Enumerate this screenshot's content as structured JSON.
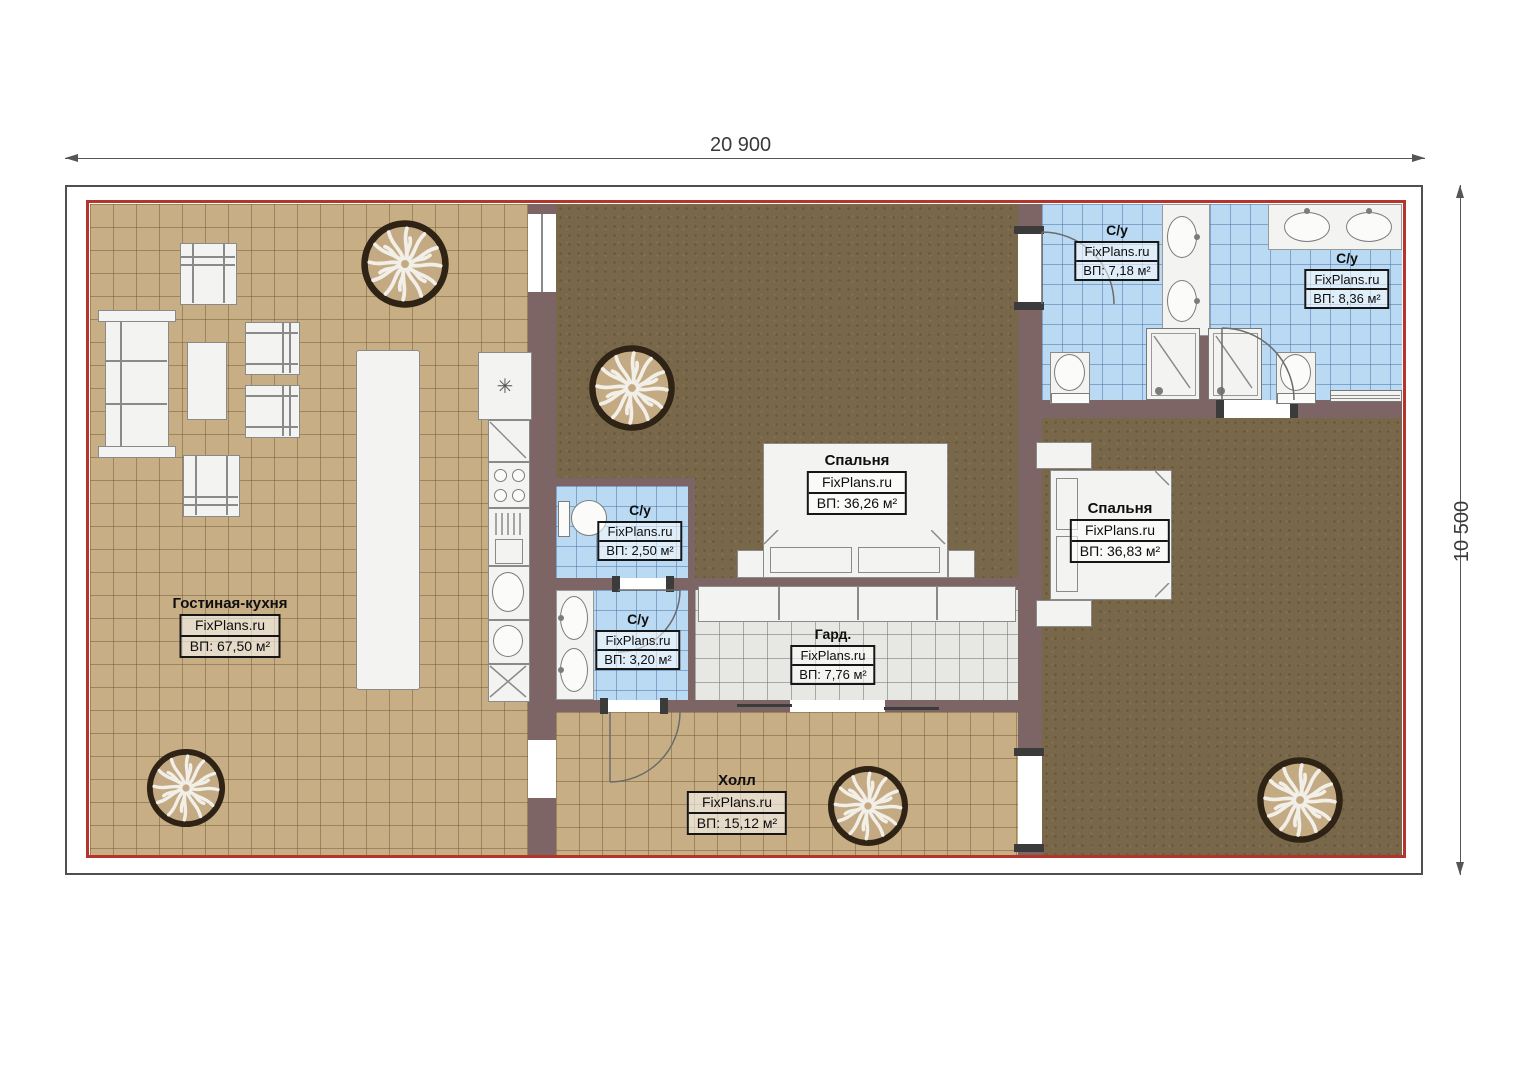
{
  "dimensions": {
    "top": "20 900",
    "right": "10 500"
  },
  "rooms": {
    "living_kitchen": {
      "name": "Гостиная-кухня",
      "watermark": "FixPlans.ru",
      "area": "ВП: 67,50 м²"
    },
    "bedroom_center": {
      "name": "Спальня",
      "watermark": "FixPlans.ru",
      "area": "ВП: 36,26 м²"
    },
    "bedroom_right": {
      "name": "Спальня",
      "watermark": "FixPlans.ru",
      "area": "ВП: 36,83 м²"
    },
    "bath_top_left": {
      "name": "С/у",
      "watermark": "FixPlans.ru",
      "area": "ВП: 7,18 м²"
    },
    "bath_top_right": {
      "name": "С/у",
      "watermark": "FixPlans.ru",
      "area": "ВП: 8,36 м²"
    },
    "bath_mid_upper": {
      "name": "С/у",
      "watermark": "FixPlans.ru",
      "area": "ВП: 2,50 м²"
    },
    "bath_mid_lower": {
      "name": "С/у",
      "watermark": "FixPlans.ru",
      "area": "ВП: 3,20 м²"
    },
    "wardrobe": {
      "name": "Гард.",
      "watermark": "FixPlans.ru",
      "area": "ВП: 7,76 м²"
    },
    "hall": {
      "name": "Холл",
      "watermark": "FixPlans.ru",
      "area": "ВП: 15,12 м²"
    }
  },
  "kitchen": {
    "fridge_symbol": "✳"
  },
  "colors": {
    "wall": "#7d6566",
    "tile_beige": "#c7ae85",
    "tile_blue": "#badaf4",
    "tile_gray": "#e7e7e4",
    "floor_brown": "#786748",
    "outline_red": "#b5352c",
    "furniture": "#f3f3f1"
  }
}
